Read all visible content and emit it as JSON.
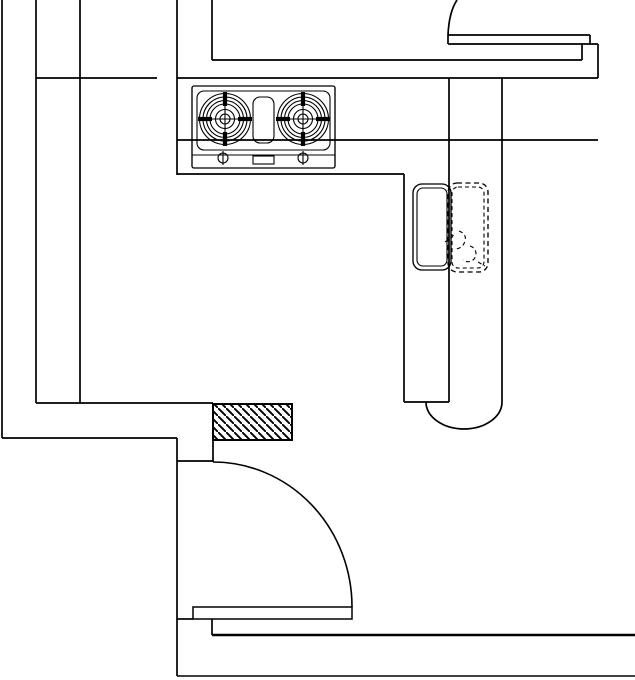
{
  "canvas": {
    "width": 635,
    "height": 680,
    "background": "#ffffff",
    "line_color": "#000000"
  },
  "plan": {
    "type": "architectural-floor-plan-kitchen",
    "elements": {
      "stove": {
        "label": "two-burner gas cooktop on counter",
        "burner_count": 2
      },
      "sink": {
        "label": "kitchen sink, solid outline"
      },
      "sink_dashed": {
        "label": "sink alternate position, dashed outline"
      },
      "faucet": {
        "label": "faucet symbol, dashed"
      },
      "column": {
        "label": "hatched wall column section"
      },
      "door": {
        "label": "hinged door with quarter-circle swing arc"
      },
      "counter": {
        "label": "counter peninsula with rounded end"
      },
      "walls": {
        "label": "wall lines"
      }
    }
  }
}
